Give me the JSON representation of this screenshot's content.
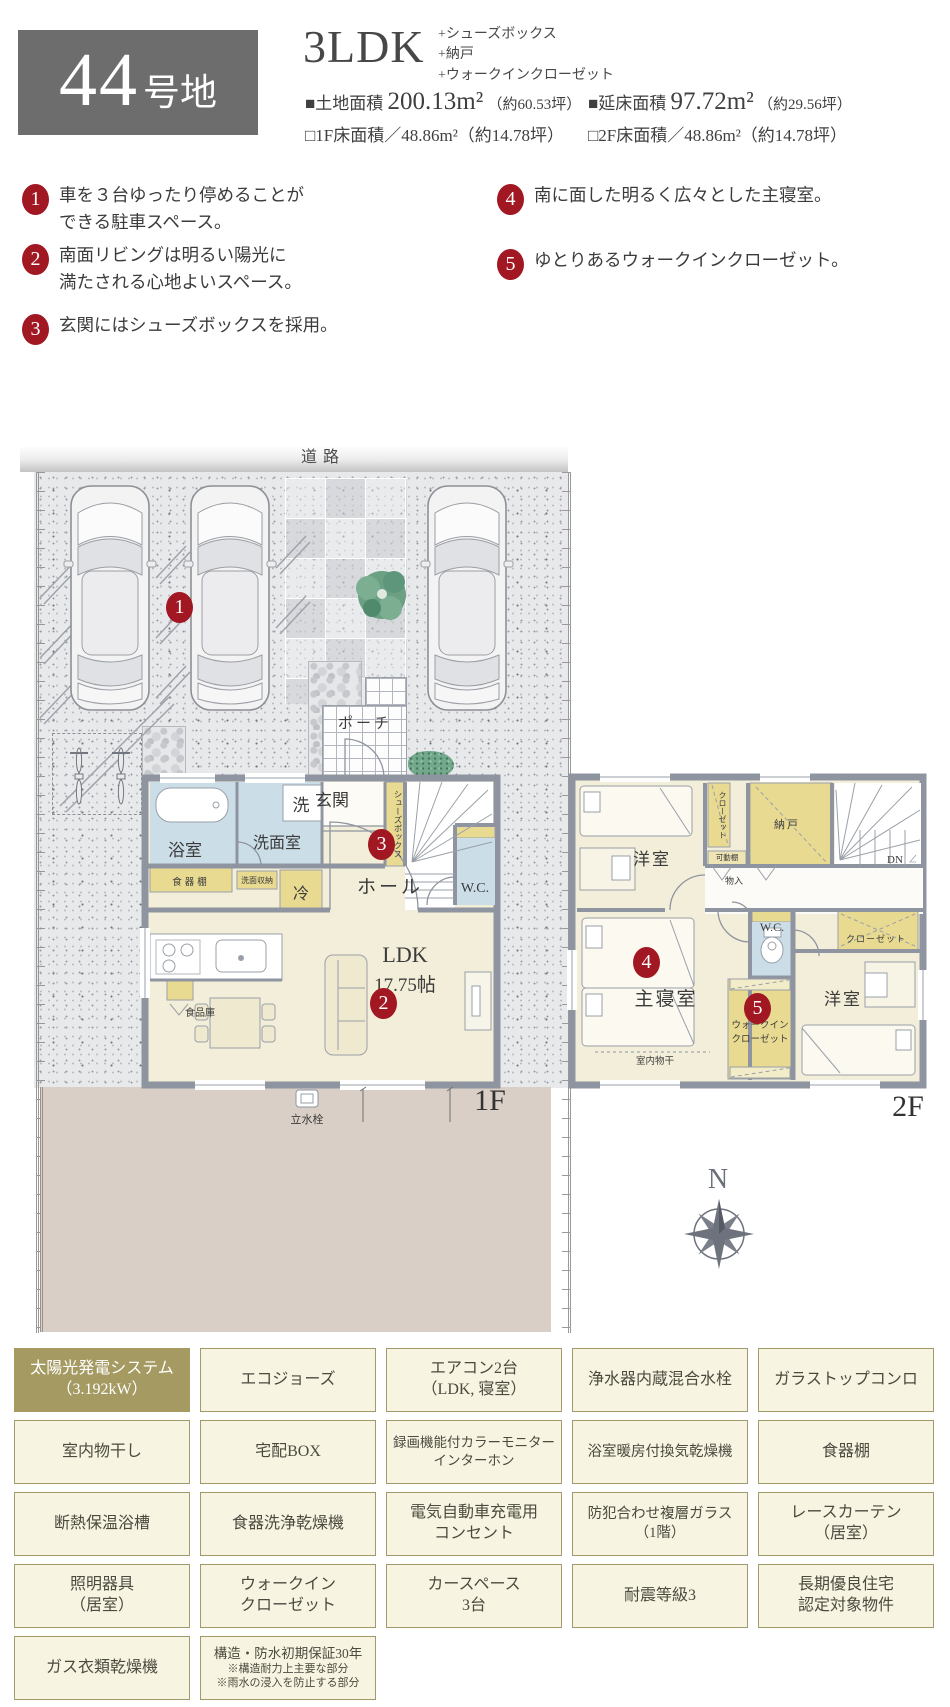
{
  "header": {
    "lot_number": "44",
    "lot_suffix": "号地",
    "plan_type": "3LDK",
    "plan_extras": [
      "+シューズボックス",
      "+納戸",
      "+ウォークインクローゼット"
    ],
    "land_area": {
      "label": "■土地面積",
      "value": "200.13m²",
      "tsubo": "（約60.53坪）"
    },
    "total_area": {
      "label": "■延床面積",
      "value": "97.72m²",
      "tsubo": "（約29.56坪）"
    },
    "floor1_area": "□1F床面積／48.86m²（約14.78坪）",
    "floor2_area": "□2F床面積／48.86m²（約14.78坪）"
  },
  "features": [
    {
      "num": "1",
      "line1": "車を３台ゆったり停めることが",
      "line2": "できる駐車スペース。"
    },
    {
      "num": "2",
      "line1": "南面リビングは明るい陽光に",
      "line2": "満たされる心地よいスペース。"
    },
    {
      "num": "3",
      "line1": "玄関にはシューズボックスを採用。",
      "line2": ""
    },
    {
      "num": "4",
      "line1": "南に面した明るく広々とした主寝室。",
      "line2": ""
    },
    {
      "num": "5",
      "line1": "ゆとりあるウォークインクローゼット。",
      "line2": ""
    }
  ],
  "site": {
    "road": "道路",
    "porch": "ポーチ",
    "tap": "立水栓",
    "floor_label": "1F",
    "marker": "1"
  },
  "plan1f": {
    "bath": "浴室",
    "washer": "洗",
    "washroom": "洗面室",
    "entrance": "玄関",
    "shoebox": "シューズボックス",
    "marker3": "3",
    "cupboard": "食器棚",
    "wash_storage": "洗面収納",
    "fridge": "冷",
    "hall": "ホール",
    "wc": "W.C.",
    "ldk": "LDK",
    "ldk_size": "17.75帖",
    "marker2": "2",
    "pantry": "食品庫"
  },
  "plan2f": {
    "bedroom_a": "洋室",
    "closet_a": "クローゼット",
    "movable_shelf": "可動棚",
    "storage_room": "納戸",
    "dn": "DN",
    "storage_small": "物入",
    "wc": "W.C.",
    "marker4": "4",
    "master_bedroom": "主寝室",
    "indoor_drying": "室内物干",
    "marker5": "5",
    "wic_line1": "ウォークイン",
    "wic_line2": "クローゼット",
    "closet_b": "クローゼット",
    "bedroom_b": "洋室",
    "floor_label": "2F"
  },
  "compass": {
    "north": "N"
  },
  "equipment_tags": [
    {
      "line1": "太陽光発電システム",
      "line2": "（3.192kW）",
      "highlight": true
    },
    {
      "line1": "エコジョーズ",
      "line2": ""
    },
    {
      "line1": "エアコン2台",
      "line2": "（LDK, 寝室）"
    },
    {
      "line1": "浄水器内蔵混合水栓",
      "line2": ""
    },
    {
      "line1": "ガラストップコンロ",
      "line2": ""
    },
    {
      "line1": "室内物干し",
      "line2": ""
    },
    {
      "line1": "宅配BOX",
      "line2": ""
    },
    {
      "line1": "録画機能付カラーモニター",
      "line2": "インターホン"
    },
    {
      "line1": "浴室暖房付換気乾燥機",
      "line2": ""
    },
    {
      "line1": "食器棚",
      "line2": ""
    },
    {
      "line1": "断熱保温浴槽",
      "line2": ""
    },
    {
      "line1": "食器洗浄乾燥機",
      "line2": ""
    },
    {
      "line1": "電気自動車充電用",
      "line2": "コンセント"
    },
    {
      "line1": "防犯合わせ複層ガラス",
      "line2": "（1階）"
    },
    {
      "line1": "レースカーテン",
      "line2": "（居室）"
    },
    {
      "line1": "照明器具",
      "line2": "（居室）"
    },
    {
      "line1": "ウォークイン",
      "line2": "クローゼット"
    },
    {
      "line1": "カースペース",
      "line2": "3台"
    },
    {
      "line1": "耐震等級3",
      "line2": ""
    },
    {
      "line1": "長期優良住宅",
      "line2": "認定対象物件"
    },
    {
      "line1": "ガス衣類乾燥機",
      "line2": ""
    },
    {
      "line1": "構造・防水初期保証30年",
      "note1": "※構造耐力上主要な部分",
      "note2": "※雨水の浸入を防止する部分"
    }
  ]
}
